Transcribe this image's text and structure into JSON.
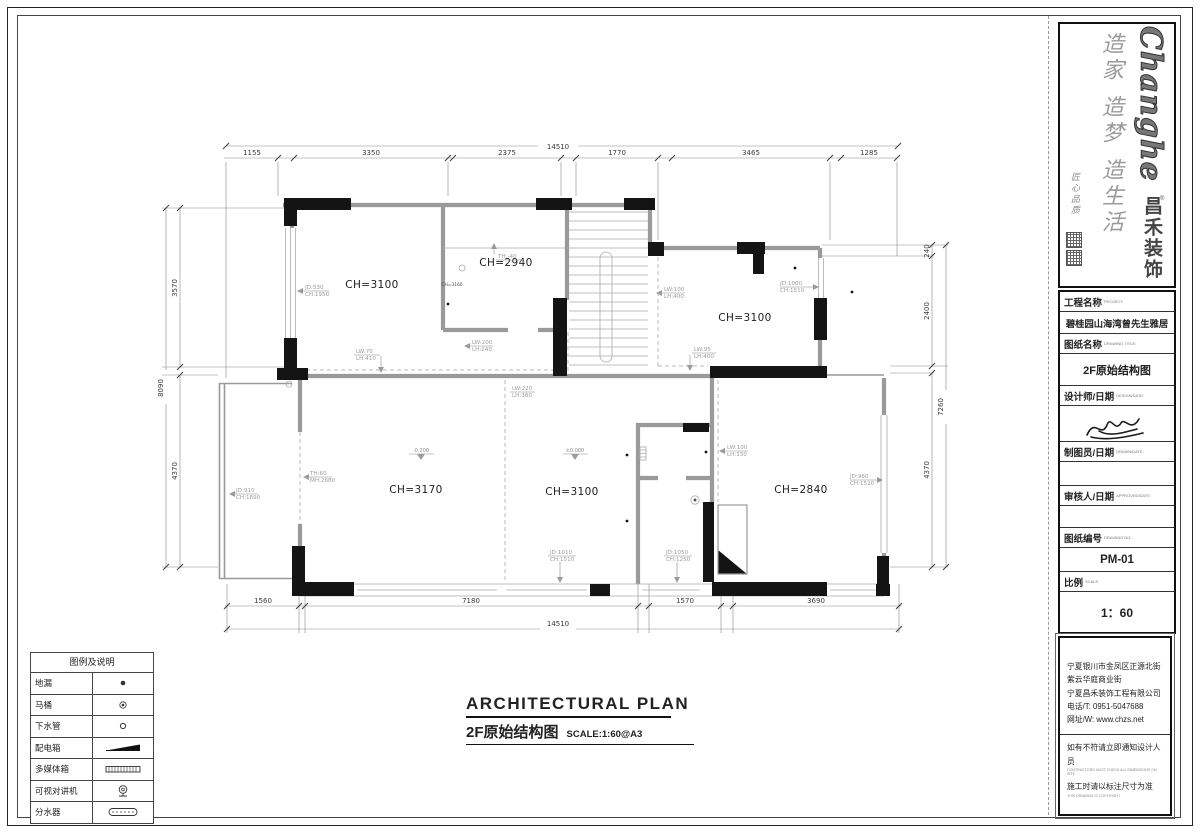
{
  "brand": {
    "logo_en": "Changhe",
    "logo_cn": "昌禾装饰",
    "reg_mark": "®",
    "slogan": "造家 造梦 造生活",
    "tagline": "匠心品质"
  },
  "title_block": {
    "project_label": "工程名称",
    "project_label_en": "PROJECT:",
    "project_value": "碧桂园山海湾曾先生雅居",
    "drawing_label": "图纸名称",
    "drawing_label_en": "DRAWING TITLE:",
    "drawing_value": "2F原始结构图",
    "designer_label": "设计师/日期",
    "designer_label_en": "DESIGN/DATE:",
    "drafter_label": "制图员/日期",
    "drafter_label_en": "DRAWN/DATE:",
    "approver_label": "审核人/日期",
    "approver_label_en": "APPROVED/DATE:",
    "no_label": "图纸编号",
    "no_label_en": "DRAWING NO.:",
    "no_value": "PM-01",
    "scale_label": "比例",
    "scale_label_en": "SCALE:",
    "scale_value": "1：60"
  },
  "company": {
    "address1": "宁夏银川市金凤区正源北街",
    "address2": "紫云华庭商业街",
    "name": "宁夏昌禾装饰工程有限公司",
    "phone": "电话/T: 0951-5047688",
    "web": "网址/W: www.chzs.net",
    "note1": "如有不符请立即通知设计人员",
    "note1_en": "CONTRACTORS MUST CHECK ALL DIMENSIONS ON SITE",
    "note2": "施工时请以标注尺寸为准",
    "note2_en": "THIS DRAWING IS COPYRIGHT"
  },
  "legend": {
    "title": "图例及说明",
    "items": [
      {
        "name": "地漏"
      },
      {
        "name": "马桶"
      },
      {
        "name": "下水管"
      },
      {
        "name": "配电箱"
      },
      {
        "name": "多媒体箱"
      },
      {
        "name": "可视对讲机"
      },
      {
        "name": "分水器"
      }
    ]
  },
  "sheet_title": {
    "en": "ARCHITECTURAL PLAN",
    "cn": "2F原始结构图",
    "scale": "SCALE:1:60@A3"
  },
  "rooms": {
    "upper_left": "CH=3100",
    "upper_mid": "CH=2940",
    "upper_right": "CH=3100",
    "lower_left": "CH=3170",
    "lower_mid": "CH=3100",
    "lower_right": "CH=2840",
    "hall_small": "CH=3160"
  },
  "levels": {
    "left": "-0.200",
    "mid": "±0.000"
  },
  "annotations": {
    "a1": {
      "l1": "JD:530",
      "l2": "CH:1950"
    },
    "a2": {
      "l1": "LW:70",
      "l2": "LH:410"
    },
    "a3": {
      "l1": "LW:200",
      "l2": "LH:240"
    },
    "a4": {
      "l1": "LW:220",
      "l2": "LH:380"
    },
    "a5": {
      "l1": "LW:100",
      "l2": "LH:400"
    },
    "a6": {
      "l1": "LW:95",
      "l2": "LH:400"
    },
    "a7": {
      "l1": "JD:1000",
      "l2": "CH:1510"
    },
    "a8": {
      "l1": "LW:100",
      "l2": "LH:130"
    },
    "a9": {
      "l1": "JD:1010",
      "l2": "CH:1510"
    },
    "a10": {
      "l1": "JD:1050",
      "l2": "CH:1250"
    },
    "a11": {
      "l1": "JD:960",
      "l2": "CH:1520"
    },
    "a12": {
      "l1": "JD:910",
      "l2": "CH:1890"
    },
    "a13": {
      "l1": "TH:60",
      "l2": "MH:2680"
    },
    "a14": {
      "l1": "TH:-40",
      "l2": ""
    }
  },
  "dims": {
    "top": {
      "total": "14510",
      "segments": [
        "1155",
        "3350",
        "2375",
        "1770",
        "3465",
        "1285"
      ]
    },
    "bottom": {
      "total": "14510",
      "segments": [
        "1560",
        "7180",
        "1570",
        "3690"
      ]
    },
    "left": {
      "total": "8090",
      "segments": [
        "3570",
        "4370"
      ]
    },
    "right": {
      "total": "7260",
      "segments": [
        "240",
        "2400",
        "4370"
      ]
    }
  }
}
